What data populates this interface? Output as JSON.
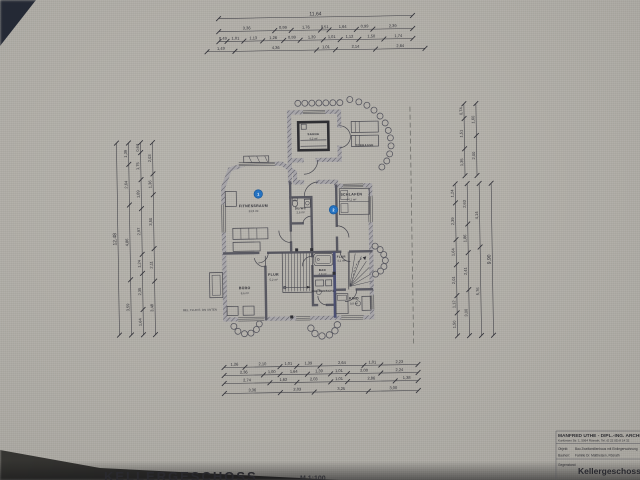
{
  "colors": {
    "paper": "#b2afa8",
    "line": "#3e3e46",
    "marker_blue": "#2273c4",
    "party_wall": "#4a4f74",
    "shadow": "#23262e"
  },
  "sheet": {
    "floor_label": "KELLERGESCHOSS",
    "floor_scale": "M 1:100",
    "annotation_small": "BEL. FLUR E. DN UNTEN"
  },
  "title_block": {
    "name": "MANFRED UTHE - DIPL.-ING. ARCHITEKT",
    "address": "Kurfürsten Str. 1, 5064 Rösrath, Tel. (0 22 05) 8 14 32",
    "rows": [
      {
        "label": "Objekt:",
        "value": "Bau Zweifamilienhaus mit Einliegerwohnung"
      },
      {
        "label": "Bauherr:",
        "value": "Familie Dr. Mattheisen, Rösrath"
      },
      {
        "label": "Gegenstand:",
        "value": "Kellergeschoss"
      }
    ],
    "subject_large": "Kellergeschoss"
  },
  "rooms": [
    {
      "name": "FITNESSRAUM",
      "area": "23,5 m²"
    },
    {
      "name": "SAUNA",
      "area": "4,2 m²"
    },
    {
      "name": "TERRASSE",
      "area": ""
    },
    {
      "name": "DU/WC",
      "area": "2,6 m²"
    },
    {
      "name": "SCHLAFEN",
      "area": "14,1 m²"
    },
    {
      "name": "BÜRO",
      "area": "8,6 m²"
    },
    {
      "name": "FLUR",
      "area": "5,2 m²"
    },
    {
      "name": "BAD",
      "area": "4,8 m²"
    },
    {
      "name": "FLUR",
      "area": "4,1 m²"
    },
    {
      "name": "KIND",
      "area": "9,8 m²"
    },
    {
      "name": "HAUSANSCHL.",
      "area": ""
    }
  ],
  "markers": [
    {
      "label": "1"
    },
    {
      "label": "2"
    }
  ],
  "dimensions": {
    "horizontal": [
      {
        "y": 17,
        "x1": 222,
        "x2": 416,
        "values": [
          "11,64"
        ],
        "fs": 5
      },
      {
        "y": 30,
        "x1": 222,
        "x2": 416,
        "values": [
          "3,36",
          "0,99",
          "1,76",
          "0,51",
          "1,64",
          "0,99",
          "2,39"
        ]
      },
      {
        "y": 40,
        "x1": 222,
        "x2": 416,
        "values": [
          "0,49",
          "1,01",
          "1,13",
          "1,26",
          "0,99",
          "1,39",
          "1,01",
          "1,12",
          "1,50",
          "1,74"
        ]
      },
      {
        "y": 50,
        "x1": 210,
        "x2": 428,
        "values": [
          "1,49",
          "4,36",
          "1,01",
          "2,14",
          "2,64"
        ]
      },
      {
        "y": 366,
        "x1": 222,
        "x2": 416,
        "values": [
          "1,26",
          "2,10",
          "1,01",
          "1,39",
          "2,64",
          "1,01",
          "2,23"
        ]
      },
      {
        "y": 374,
        "x1": 222,
        "x2": 416,
        "values": [
          "2,36",
          "1,00",
          "1,64",
          "1,39",
          "1,01",
          "2,00",
          "2,24"
        ]
      },
      {
        "y": 382,
        "x1": 222,
        "x2": 416,
        "values": [
          "2,74",
          "1,62",
          "2,03",
          "1,01",
          "2,86",
          "1,38"
        ]
      },
      {
        "y": 392,
        "x1": 222,
        "x2": 416,
        "values": [
          "3,36",
          "2,03",
          "3,25",
          "3,00"
        ]
      }
    ],
    "vertical": [
      {
        "x": 118,
        "y1": 140,
        "y2": 332,
        "values": [
          "12,48"
        ],
        "fs": 5
      },
      {
        "x": 130,
        "y1": 140,
        "y2": 332,
        "values": [
          "1,39",
          "2,64",
          "4,86",
          "3,59"
        ]
      },
      {
        "x": 142,
        "y1": 140,
        "y2": 332,
        "values": [
          "0,64",
          "1,75",
          "1,89",
          "2,97",
          "1,24",
          "2,35",
          "1,64"
        ]
      },
      {
        "x": 154,
        "y1": 140,
        "y2": 332,
        "values": [
          "2,03",
          "1,36",
          "3,50",
          "2,11",
          "3,48"
        ]
      },
      {
        "x": 466,
        "y1": 106,
        "y2": 178,
        "values": [
          "0,74",
          "1,51",
          "1,35"
        ]
      },
      {
        "x": 478,
        "y1": 106,
        "y2": 178,
        "values": [
          "1,60",
          "2,00"
        ]
      },
      {
        "x": 456,
        "y1": 186,
        "y2": 338,
        "values": [
          "1,24",
          "2,39",
          "1,64",
          "2,01",
          "1,12",
          "1,50"
        ]
      },
      {
        "x": 468,
        "y1": 186,
        "y2": 338,
        "values": [
          "2,63",
          "1,86",
          "2,41",
          "3,00"
        ]
      },
      {
        "x": 480,
        "y1": 186,
        "y2": 338,
        "values": [
          "4,14",
          "5,76"
        ]
      },
      {
        "x": 492,
        "y1": 186,
        "y2": 338,
        "values": [
          "9,90"
        ],
        "fs": 5
      }
    ]
  }
}
